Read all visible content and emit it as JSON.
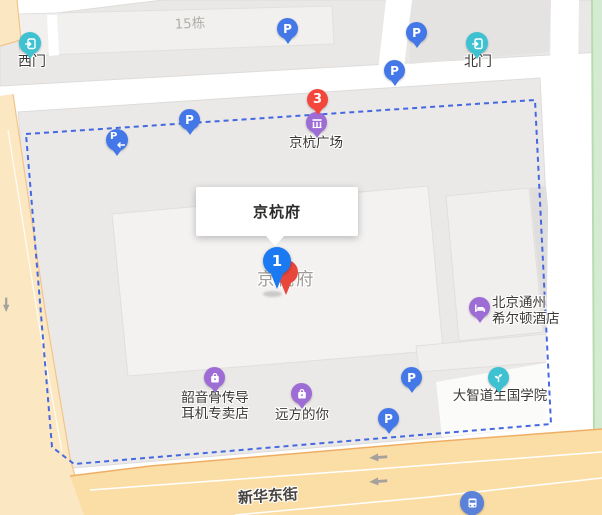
{
  "callout": {
    "title": "京杭府"
  },
  "pins": {
    "selected_number": "1",
    "plaza_number": "3"
  },
  "parking": {
    "letter": "P"
  },
  "labels": {
    "west_gate": "西门",
    "north_gate": "北门",
    "building15": "15栋",
    "plaza": "京杭广场",
    "place_ghost": "京杭府",
    "hotel": [
      "北京通州",
      "希尔顿酒店"
    ],
    "headphone_store": [
      "韶音骨传导",
      "耳机专卖店"
    ],
    "faraway_shop": "远方的你",
    "academy": "大智道生国学院",
    "street": "新华东街"
  },
  "icons": {
    "parking": "blue-circle-P",
    "parking_entrance": "blue-circle-P-left-arrow",
    "gate": "teal-circle-door-arrow",
    "mall": "purple-circle-storefront",
    "hotel": "purple-circle-bed",
    "shop": "purple-circle-shopping-bag",
    "academy": "teal-circle-sprout",
    "bus_stop": "blue-circle-bus"
  },
  "colors": {
    "boundary_dash": "#4568e0",
    "parking_blue": "#4478e8",
    "poi_purple": "#9d6cd5",
    "poi_teal": "#3ec1d1",
    "marker_red": "#f4473b",
    "pin_blue": "#1b79f2",
    "road_major": "#fbdda6",
    "road_minor": "#fbe8c2",
    "green_area": "#d5ebd1",
    "block_gray": "#eae9e8",
    "building_light": "#f3f2f1"
  }
}
